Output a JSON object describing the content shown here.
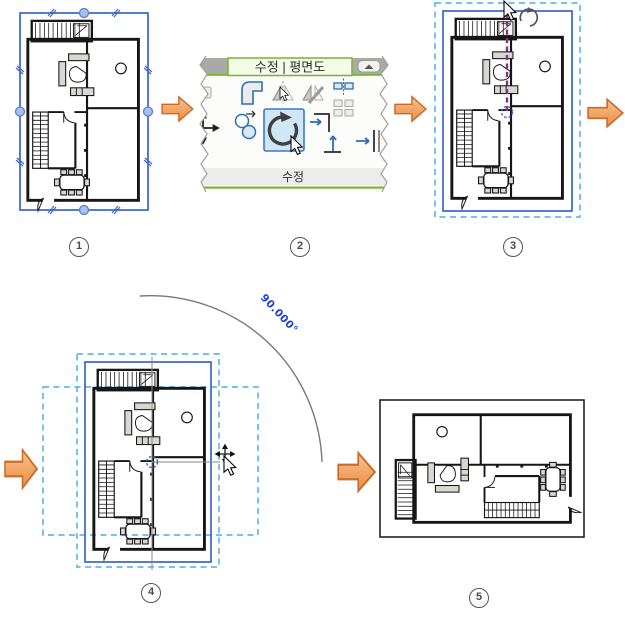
{
  "ribbon": {
    "tab_label": "수정 | 평면도",
    "panel_label": "수정",
    "icon_names": [
      "offset-icon",
      "fillet-icon",
      "mirror-pick-axis-icon",
      "mirror-draw-axis-icon",
      "split-element-icon",
      "array-icon",
      "move-icon",
      "copy-icon",
      "rotate-icon",
      "trim-extend-corner-icon",
      "trim-extend-single-icon",
      "collapse-ribbon-icon"
    ]
  },
  "rotation": {
    "angle_label": "90.000°"
  },
  "steps": [
    {
      "number": "1"
    },
    {
      "number": "2"
    },
    {
      "number": "3"
    },
    {
      "number": "4"
    },
    {
      "number": "5"
    }
  ],
  "colors": {
    "selection_blue": "#3a64cc",
    "dash_blue": "#62b9e8",
    "axis_purple": "#8a2f8a",
    "angle_blue": "#1b3fd6",
    "ribbon_green": "#74b62e",
    "arrow_orange": "#f2a269",
    "arrow_border": "#c96a2a",
    "plan_gray": "#c6c6c6",
    "fixture_cyan": "#29c8ee",
    "light_yellow": "#f8f4ac",
    "table_yellow": "#f8f4bc"
  }
}
